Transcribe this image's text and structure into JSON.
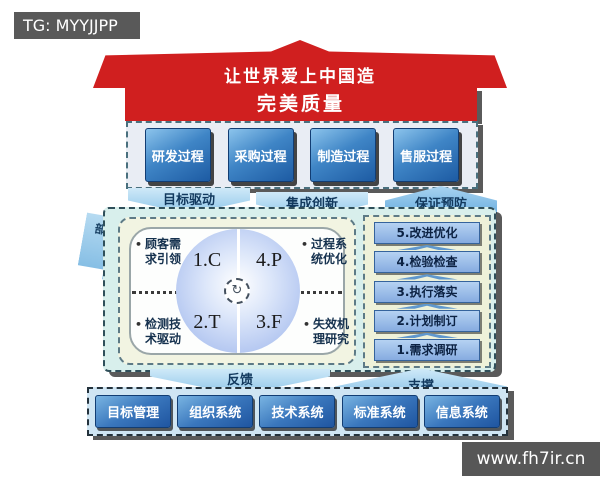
{
  "watermarks": {
    "tag": "TG: MYYJJPP",
    "site": "www.fh7ir.cn"
  },
  "roof": {
    "slogan": "让世界爱上中国造",
    "banner": "完美质量"
  },
  "processes": [
    "研发过程",
    "采购过程",
    "制造过程",
    "售服过程"
  ],
  "flow_labels": {
    "goal": "目标驱动",
    "innovation": "集成创新",
    "prevention": "保证预防",
    "feedback": "反馈",
    "support": "支撑",
    "internal_external": "内外部"
  },
  "quadrant": {
    "bullet": "•",
    "sectors": {
      "tl": "1.C",
      "tr": "4.P",
      "bl": "2.T",
      "br": "3.F"
    },
    "center_icon_glyph": "↻",
    "corner_labels": {
      "tl": {
        "line1": "顾客需",
        "line2": "求引领"
      },
      "tr": {
        "line1": "过程系",
        "line2": "统优化"
      },
      "bl": {
        "line1": "检测技",
        "line2": "术驱动"
      },
      "br": {
        "line1": "失效机",
        "line2": "理研究"
      }
    }
  },
  "steps": [
    "5.改进优化",
    "4.检验检查",
    "3.执行落实",
    "2.计划制订",
    "1.需求调研"
  ],
  "systems": [
    "目标管理",
    "组织系统",
    "技术系统",
    "标准系统",
    "信息系统"
  ],
  "colors": {
    "roof_red": "#d01f1f",
    "process_blue": "#1d5ba3",
    "panel_cyan": "#d8efec",
    "panel_cream": "#f2f4e2",
    "arrow_blue": "#8fc6e9",
    "watermark_gray": "#595959"
  }
}
